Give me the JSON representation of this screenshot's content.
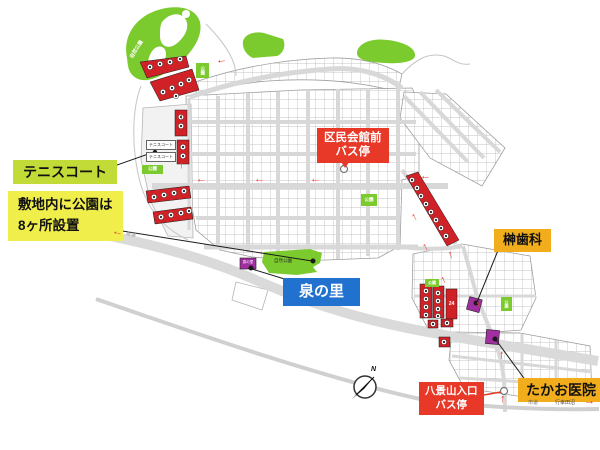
{
  "callouts": {
    "tennis_court": "テニスコート",
    "parks_note_line1": "敷地内に公園は",
    "parks_note_line2": "8ヶ所設置",
    "izumi_no_sato": "泉の里",
    "kumin_kaikan_line1": "区民会館前",
    "kumin_kaikan_line2": "バス停",
    "sakaki_dental": "榊歯科",
    "takao_clinic": "たかお医院",
    "hakkeyama_line1": "八景山入口",
    "hakkeyama_line2": "バス停"
  },
  "map_labels": {
    "nature_park": "自然公園",
    "park": "公園",
    "tennis_court_small": "テニスコート",
    "izumi_small": "泉の里",
    "prefectural_road": "県道",
    "city_road": "市道",
    "miyukida_numa": "行幸田沼",
    "lot_number_24": "24",
    "compass_north": "N"
  },
  "icons": {
    "arrow_left": "←",
    "arrow_up": "↑",
    "arrow_right": "→"
  },
  "colors": {
    "callout_yellow_green": "#c3db37",
    "callout_yellow": "#f0ee4b",
    "callout_blue": "#2171ce",
    "callout_red": "#e73828",
    "callout_orange": "#f1ad1b",
    "park_green": "#7ccb2e",
    "lot_red": "#cf2126",
    "site_purple": "#a0309f",
    "road_gray": "#d9d9d9"
  }
}
